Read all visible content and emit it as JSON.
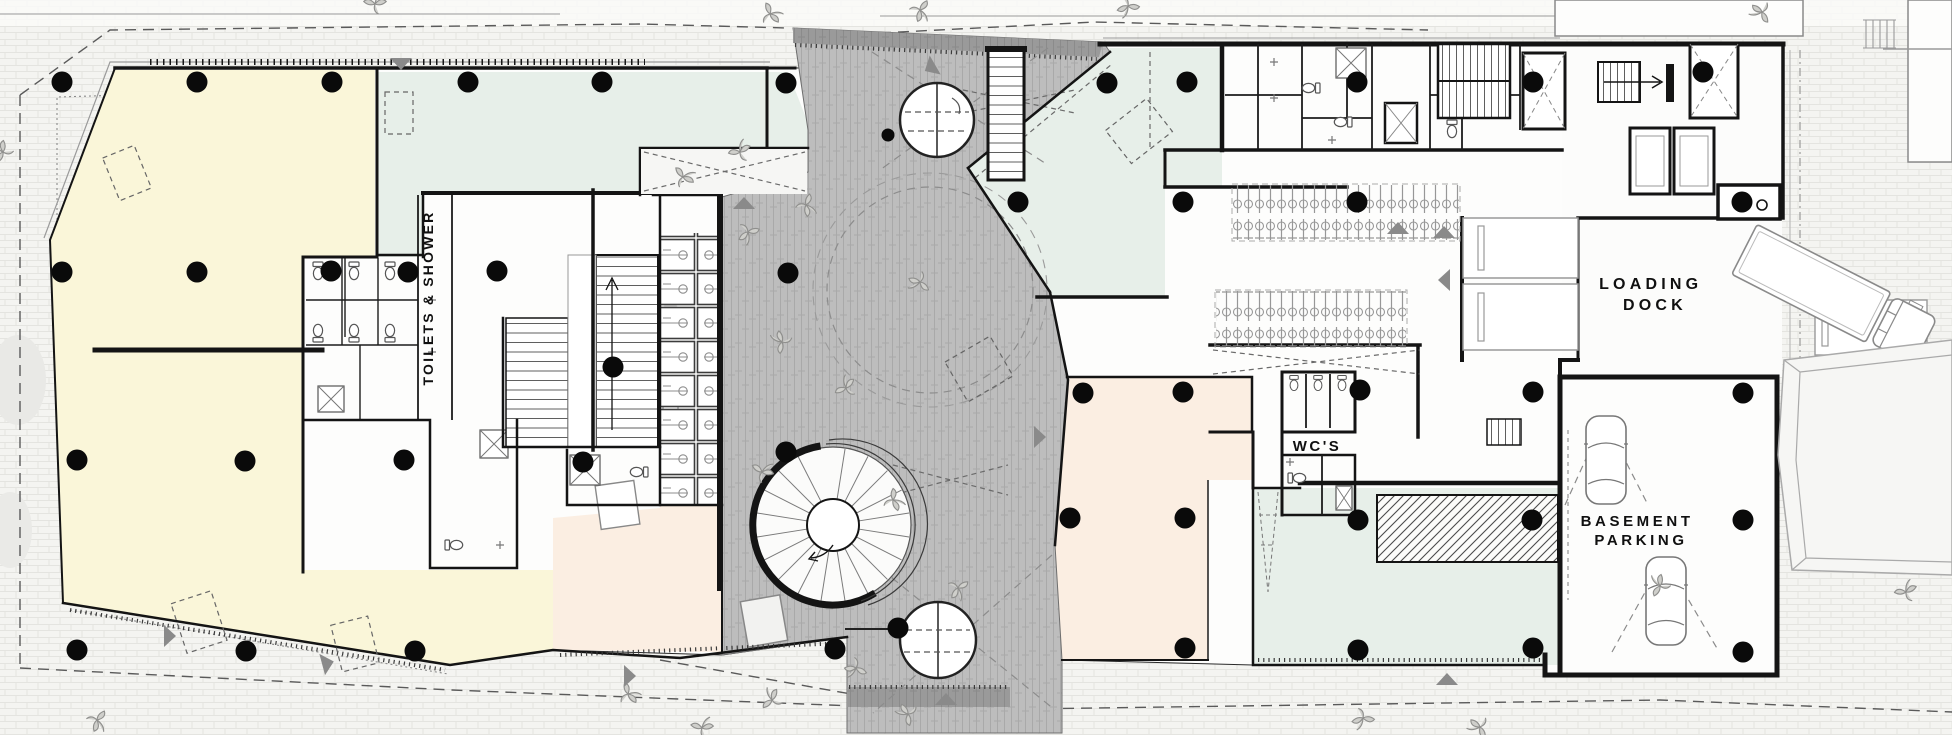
{
  "labels": {
    "toilets_shower": "TOILETS & SHOWER",
    "wcs": "WC'S",
    "loading_dock": [
      "LOADING",
      "DOCK"
    ],
    "basement_parking": [
      "BASEMENT",
      "PARKING"
    ]
  },
  "colors": {
    "street_bg": "#f4f4f1",
    "paver_line": "#e4e4e0",
    "tenancy_yellow": "#faf6d9",
    "zone_teal": "#e7efe9",
    "zone_pink": "#fbeee2",
    "plaza_gray": "#bdbdbd",
    "plaza_brick_line": "#a9a9a9",
    "plaza_dark": "#9a9a9a",
    "plaza_dark_line": "#8b8b8b",
    "wall": "#141414",
    "column_dot": "#0a0a0a",
    "detail_gray": "#8a8a8a"
  },
  "structure": {
    "column_radius": 10.5,
    "columns": [
      [
        62,
        82
      ],
      [
        197,
        82
      ],
      [
        332,
        82
      ],
      [
        468,
        82
      ],
      [
        602,
        82
      ],
      [
        786,
        83
      ],
      [
        62,
        272
      ],
      [
        197,
        272
      ],
      [
        331,
        271
      ],
      [
        408,
        272
      ],
      [
        497,
        271
      ],
      [
        613,
        367
      ],
      [
        788,
        273
      ],
      [
        786,
        452
      ],
      [
        583,
        462
      ],
      [
        77,
        460
      ],
      [
        245,
        461
      ],
      [
        404,
        460
      ],
      [
        77,
        650
      ],
      [
        246,
        651
      ],
      [
        415,
        651
      ],
      [
        835,
        649
      ],
      [
        898,
        628
      ],
      [
        1107,
        83
      ],
      [
        1187,
        82
      ],
      [
        1357,
        82
      ],
      [
        1533,
        82
      ],
      [
        1703,
        72
      ],
      [
        1018,
        202
      ],
      [
        1183,
        202
      ],
      [
        1357,
        202
      ],
      [
        1742,
        202
      ],
      [
        1083,
        393
      ],
      [
        1183,
        392
      ],
      [
        1360,
        390
      ],
      [
        1533,
        392
      ],
      [
        1743,
        393
      ],
      [
        1070,
        518
      ],
      [
        1185,
        518
      ],
      [
        1358,
        520
      ],
      [
        1532,
        520
      ],
      [
        1743,
        520
      ],
      [
        1185,
        648
      ],
      [
        1358,
        650
      ],
      [
        1533,
        648
      ],
      [
        1743,
        652
      ]
    ],
    "small_columns": [
      [
        888,
        135
      ]
    ],
    "open_circles": [
      [
        1762,
        205
      ]
    ],
    "plants": [
      [
        375,
        4
      ],
      [
        770,
        14
      ],
      [
        920,
        10
      ],
      [
        1128,
        6
      ],
      [
        1762,
        12
      ],
      [
        3,
        152
      ],
      [
        740,
        152
      ],
      [
        683,
        177
      ],
      [
        806,
        205
      ],
      [
        748,
        232
      ],
      [
        920,
        282
      ],
      [
        782,
        342
      ],
      [
        846,
        388
      ],
      [
        762,
        472
      ],
      [
        893,
        500
      ],
      [
        958,
        588
      ],
      [
        856,
        668
      ],
      [
        908,
        714
      ],
      [
        772,
        700
      ],
      [
        702,
        728
      ],
      [
        628,
        694
      ],
      [
        97,
        720
      ],
      [
        1363,
        718
      ],
      [
        1480,
        727
      ],
      [
        1660,
        586
      ],
      [
        1906,
        592
      ]
    ],
    "direction_arrows": [
      [
        401,
        64,
        180
      ],
      [
        930,
        68,
        240
      ],
      [
        744,
        203,
        0
      ],
      [
        1040,
        437,
        90
      ],
      [
        1444,
        232,
        0
      ],
      [
        1444,
        280,
        270
      ],
      [
        170,
        636,
        90
      ],
      [
        328,
        663,
        75
      ],
      [
        946,
        699,
        0
      ],
      [
        1447,
        679,
        0
      ],
      [
        630,
        676,
        90
      ],
      [
        1398,
        228,
        0
      ]
    ]
  }
}
